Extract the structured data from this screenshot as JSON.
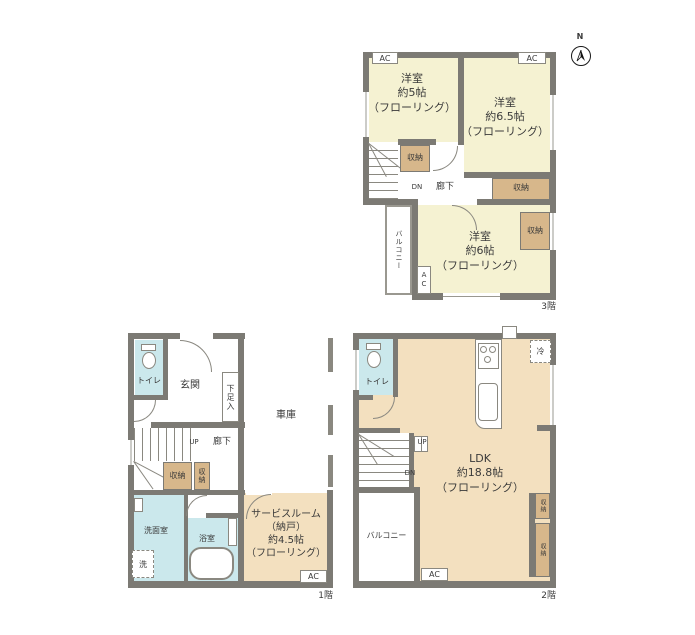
{
  "document": {
    "type": "floor-plan",
    "background": "#ffffff"
  },
  "colors": {
    "wall": "#7c7a74",
    "room_yellow": "#f5f2d2",
    "room_tan": "#f3e0bf",
    "closet_tan": "#d7b78b",
    "water_blue": "#cbe8ec",
    "text": "#3a3a3a"
  },
  "compass": {
    "north_label": "N"
  },
  "shared": {
    "ac": "AC",
    "closet": "収納",
    "hallway": "廊下",
    "toilet": "トイレ",
    "balcony": "バルコニー",
    "up": "UP",
    "dn": "DN"
  },
  "floor3": {
    "floor_label": "3階",
    "bedroom5": "洋室\n約5帖\n（フローリング）",
    "bedroom65": "洋室\n約6.5帖\n（フローリング）",
    "bedroom6": "洋室\n約6帖\n（フローリング）"
  },
  "floor1": {
    "floor_label": "1階",
    "entrance": "玄関",
    "shoe_closet": "下足入",
    "garage": "車庫",
    "washroom": "洗面室",
    "bathroom": "浴室",
    "laundry": "洗",
    "service_room": "サービスルーム\n（納戸）\n約4.5帖\n（フローリング）"
  },
  "floor2": {
    "floor_label": "2階",
    "ldk": "LDK\n約18.8帖\n（フローリング）",
    "fridge": "冷"
  }
}
